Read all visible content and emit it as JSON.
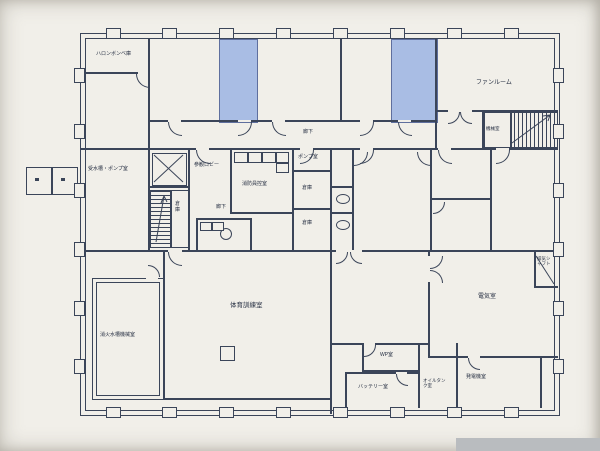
{
  "palette": {
    "line": "#3b4559",
    "paper": "#f1efe9",
    "room_fill_blue": "#a9bde4",
    "grey_strip": "#b9bcbf",
    "ink": "#242d40"
  },
  "plan_title": "地下階 平面図",
  "rooms": {
    "halon": "ハロンボンベ庫",
    "fan_room": "ファンルーム",
    "machine_small": "機械室",
    "corridor_top": "廊下",
    "pump_small": "ポンプ室",
    "water_tank_pump": "受水槽・ポンプ室",
    "lobby": "参観ロビー",
    "firefighter_room": "消防員控室",
    "storage_a": "倉庫",
    "storage_b": "倉庫",
    "storage_stair": "倉庫",
    "corridor_mid": "廊下",
    "electrical": "電気室",
    "shaft": "排気シャフト",
    "training": "体育訓練室",
    "fire_tank_machine": "消火水槽機械室",
    "wp": "WP室",
    "battery": "バッテリー室",
    "oil_tank": "オイルタンク室",
    "generator": "発電機室"
  }
}
